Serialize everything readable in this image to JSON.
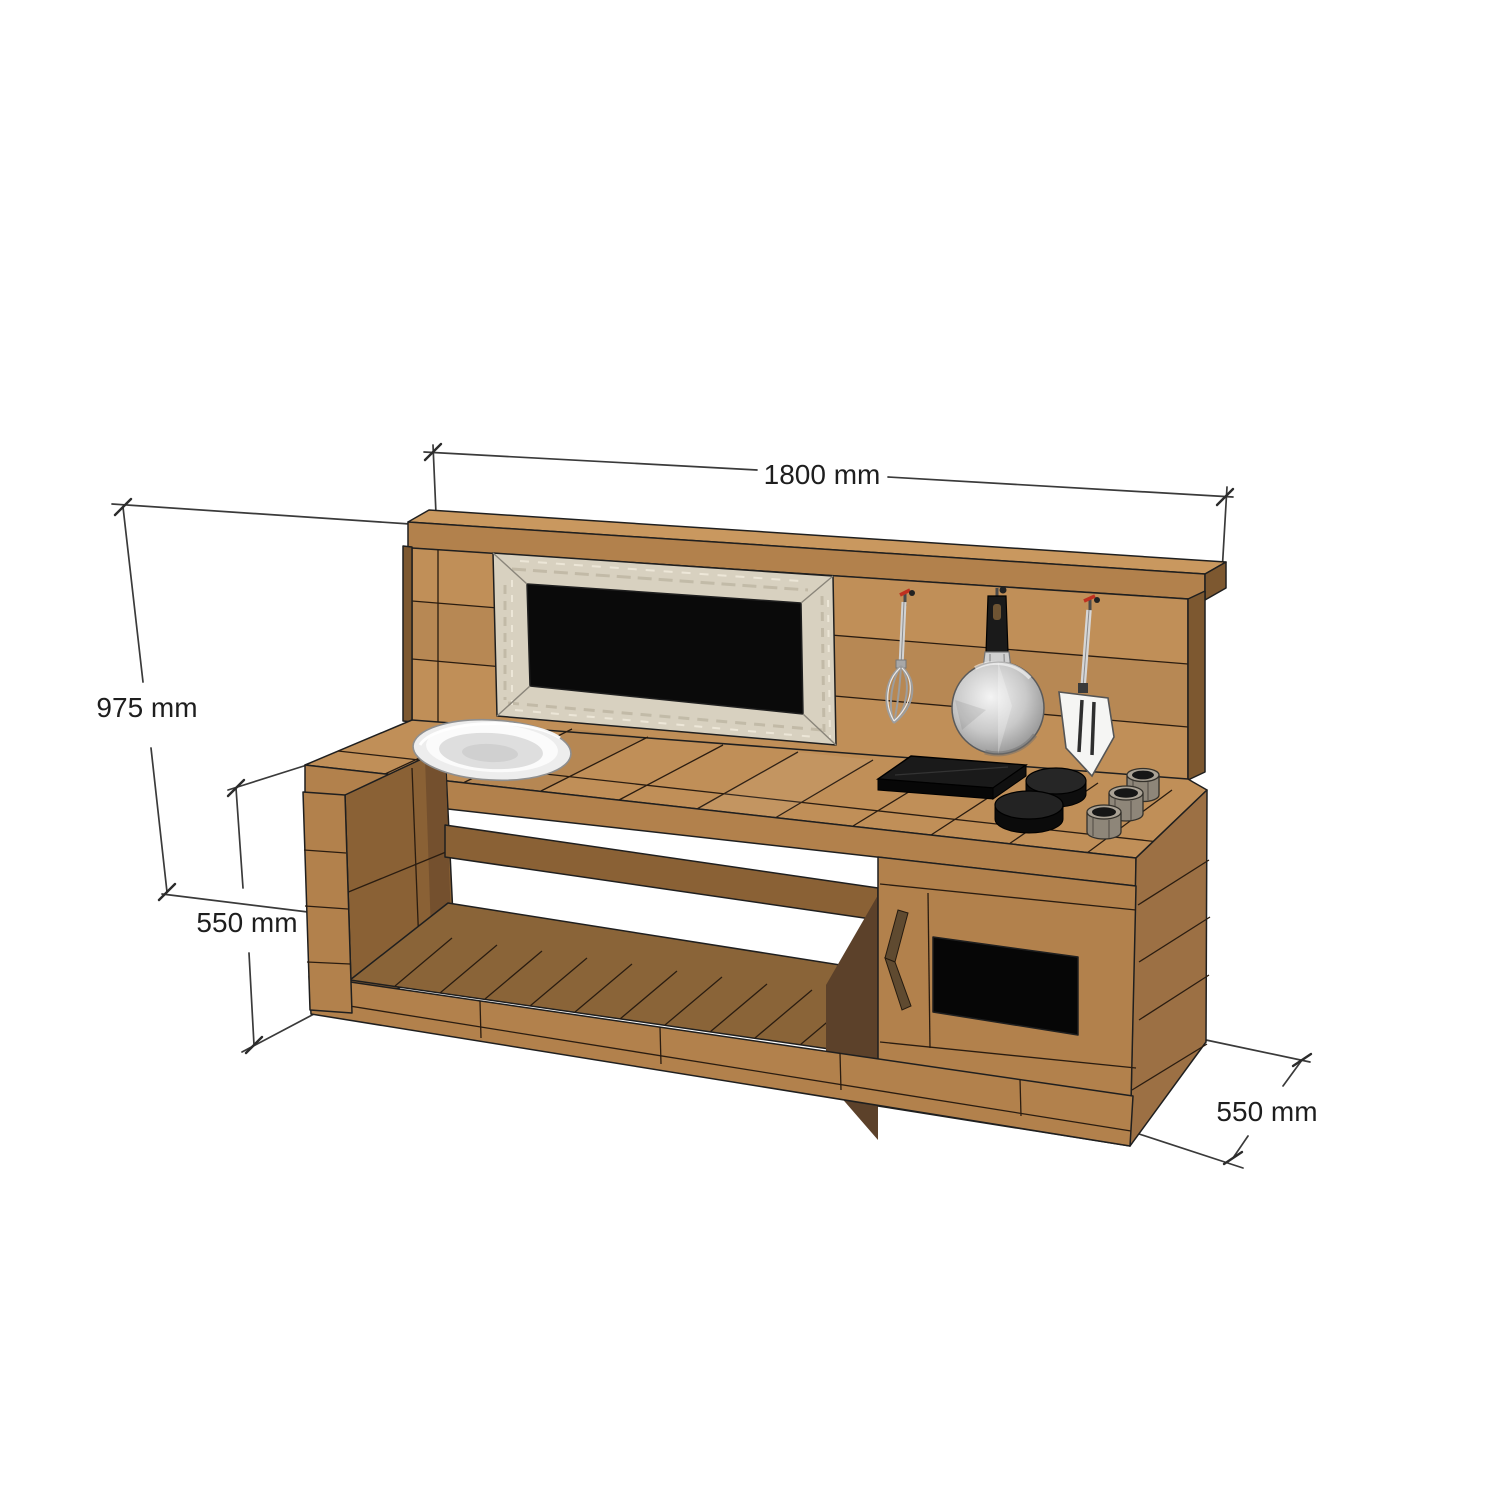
{
  "dims": {
    "width": "1800 mm",
    "height": "975 mm",
    "counter_height": "550 mm",
    "depth": "550 mm"
  },
  "colors": {
    "background": "#ffffff",
    "outline": "#1f1f1f",
    "dim_line": "#3a3a3a",
    "dim_text": "#1e1e1e",
    "wood_top": "#c08f58",
    "wood_front": "#b2814c",
    "wood_side": "#9c7044",
    "wood_dark": "#7d5830",
    "wood_inner": "#8a6135",
    "wood_shelf": "#8a6438",
    "wood_cap": "#c9985f",
    "frame_whitewash": "#d8d1c0",
    "chalkboard_black": "#0a0a0a",
    "oven_opening_black": "#060606",
    "metal_light": "#e8e8e8",
    "metal_mid": "#b9b9b9",
    "plastic_black": "#1a1a1a",
    "hook_red": "#c03020",
    "pot_grey": "#8e8679",
    "handle_brown": "#5f4a30"
  },
  "parts": {
    "subject": "wooden mud kitchen 3D dimension drawing",
    "items": [
      "backboard",
      "chalkboard",
      "whisk",
      "frying-pan",
      "spatula",
      "sink-bowl",
      "hob-plate",
      "burners",
      "log-pots",
      "counter",
      "open-shelf",
      "oven-box",
      "oven-door-handle"
    ]
  }
}
